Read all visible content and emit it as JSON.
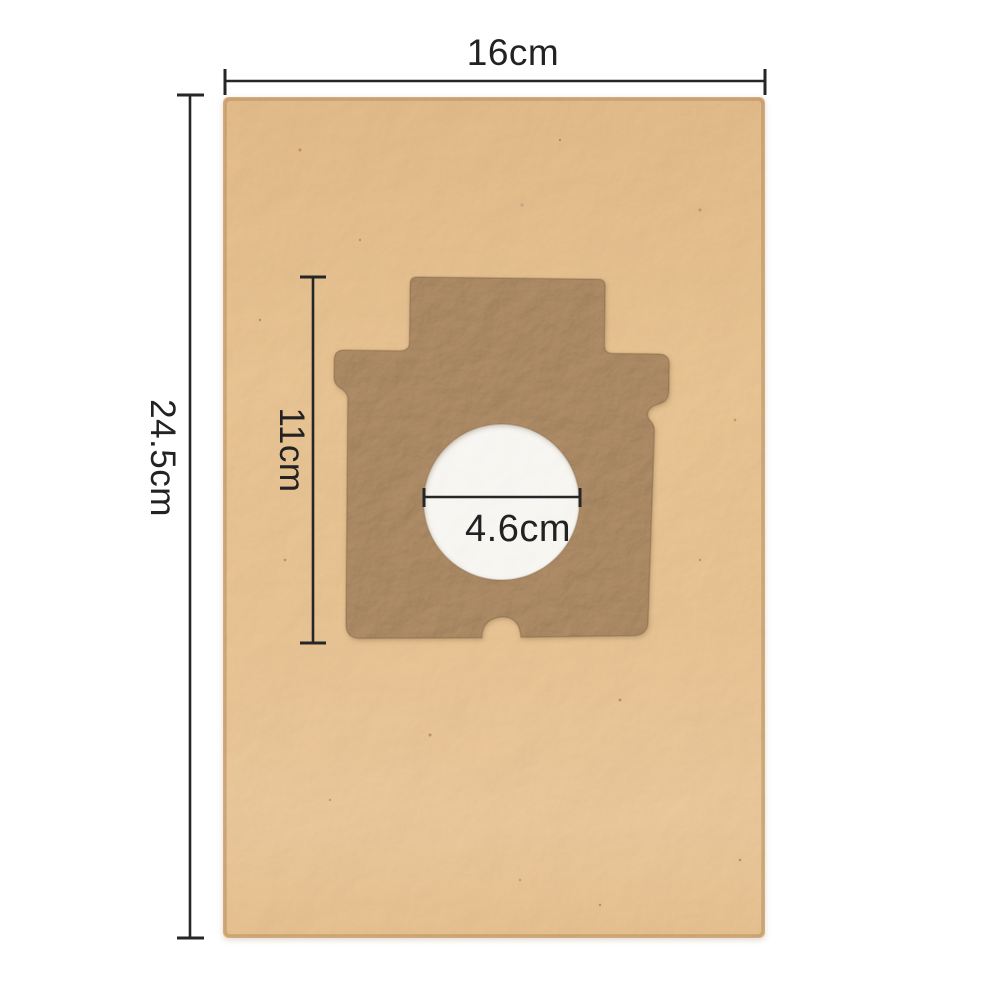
{
  "diagram": {
    "subject": "vacuum dust bag dimension diagram",
    "colors": {
      "background": "#ffffff",
      "bag_paper": "#e9c18c",
      "collar_cardboard": "#a6875f",
      "hole_filter": "#f7f5f1",
      "dimension_lines": "#262626",
      "label_text": "#222222"
    },
    "dimensions": {
      "bag_width": {
        "label": "16cm"
      },
      "bag_height": {
        "label": "24.5cm"
      },
      "collar_height": {
        "label": "11cm"
      },
      "hole_diameter": {
        "label": "4.6cm"
      }
    }
  }
}
